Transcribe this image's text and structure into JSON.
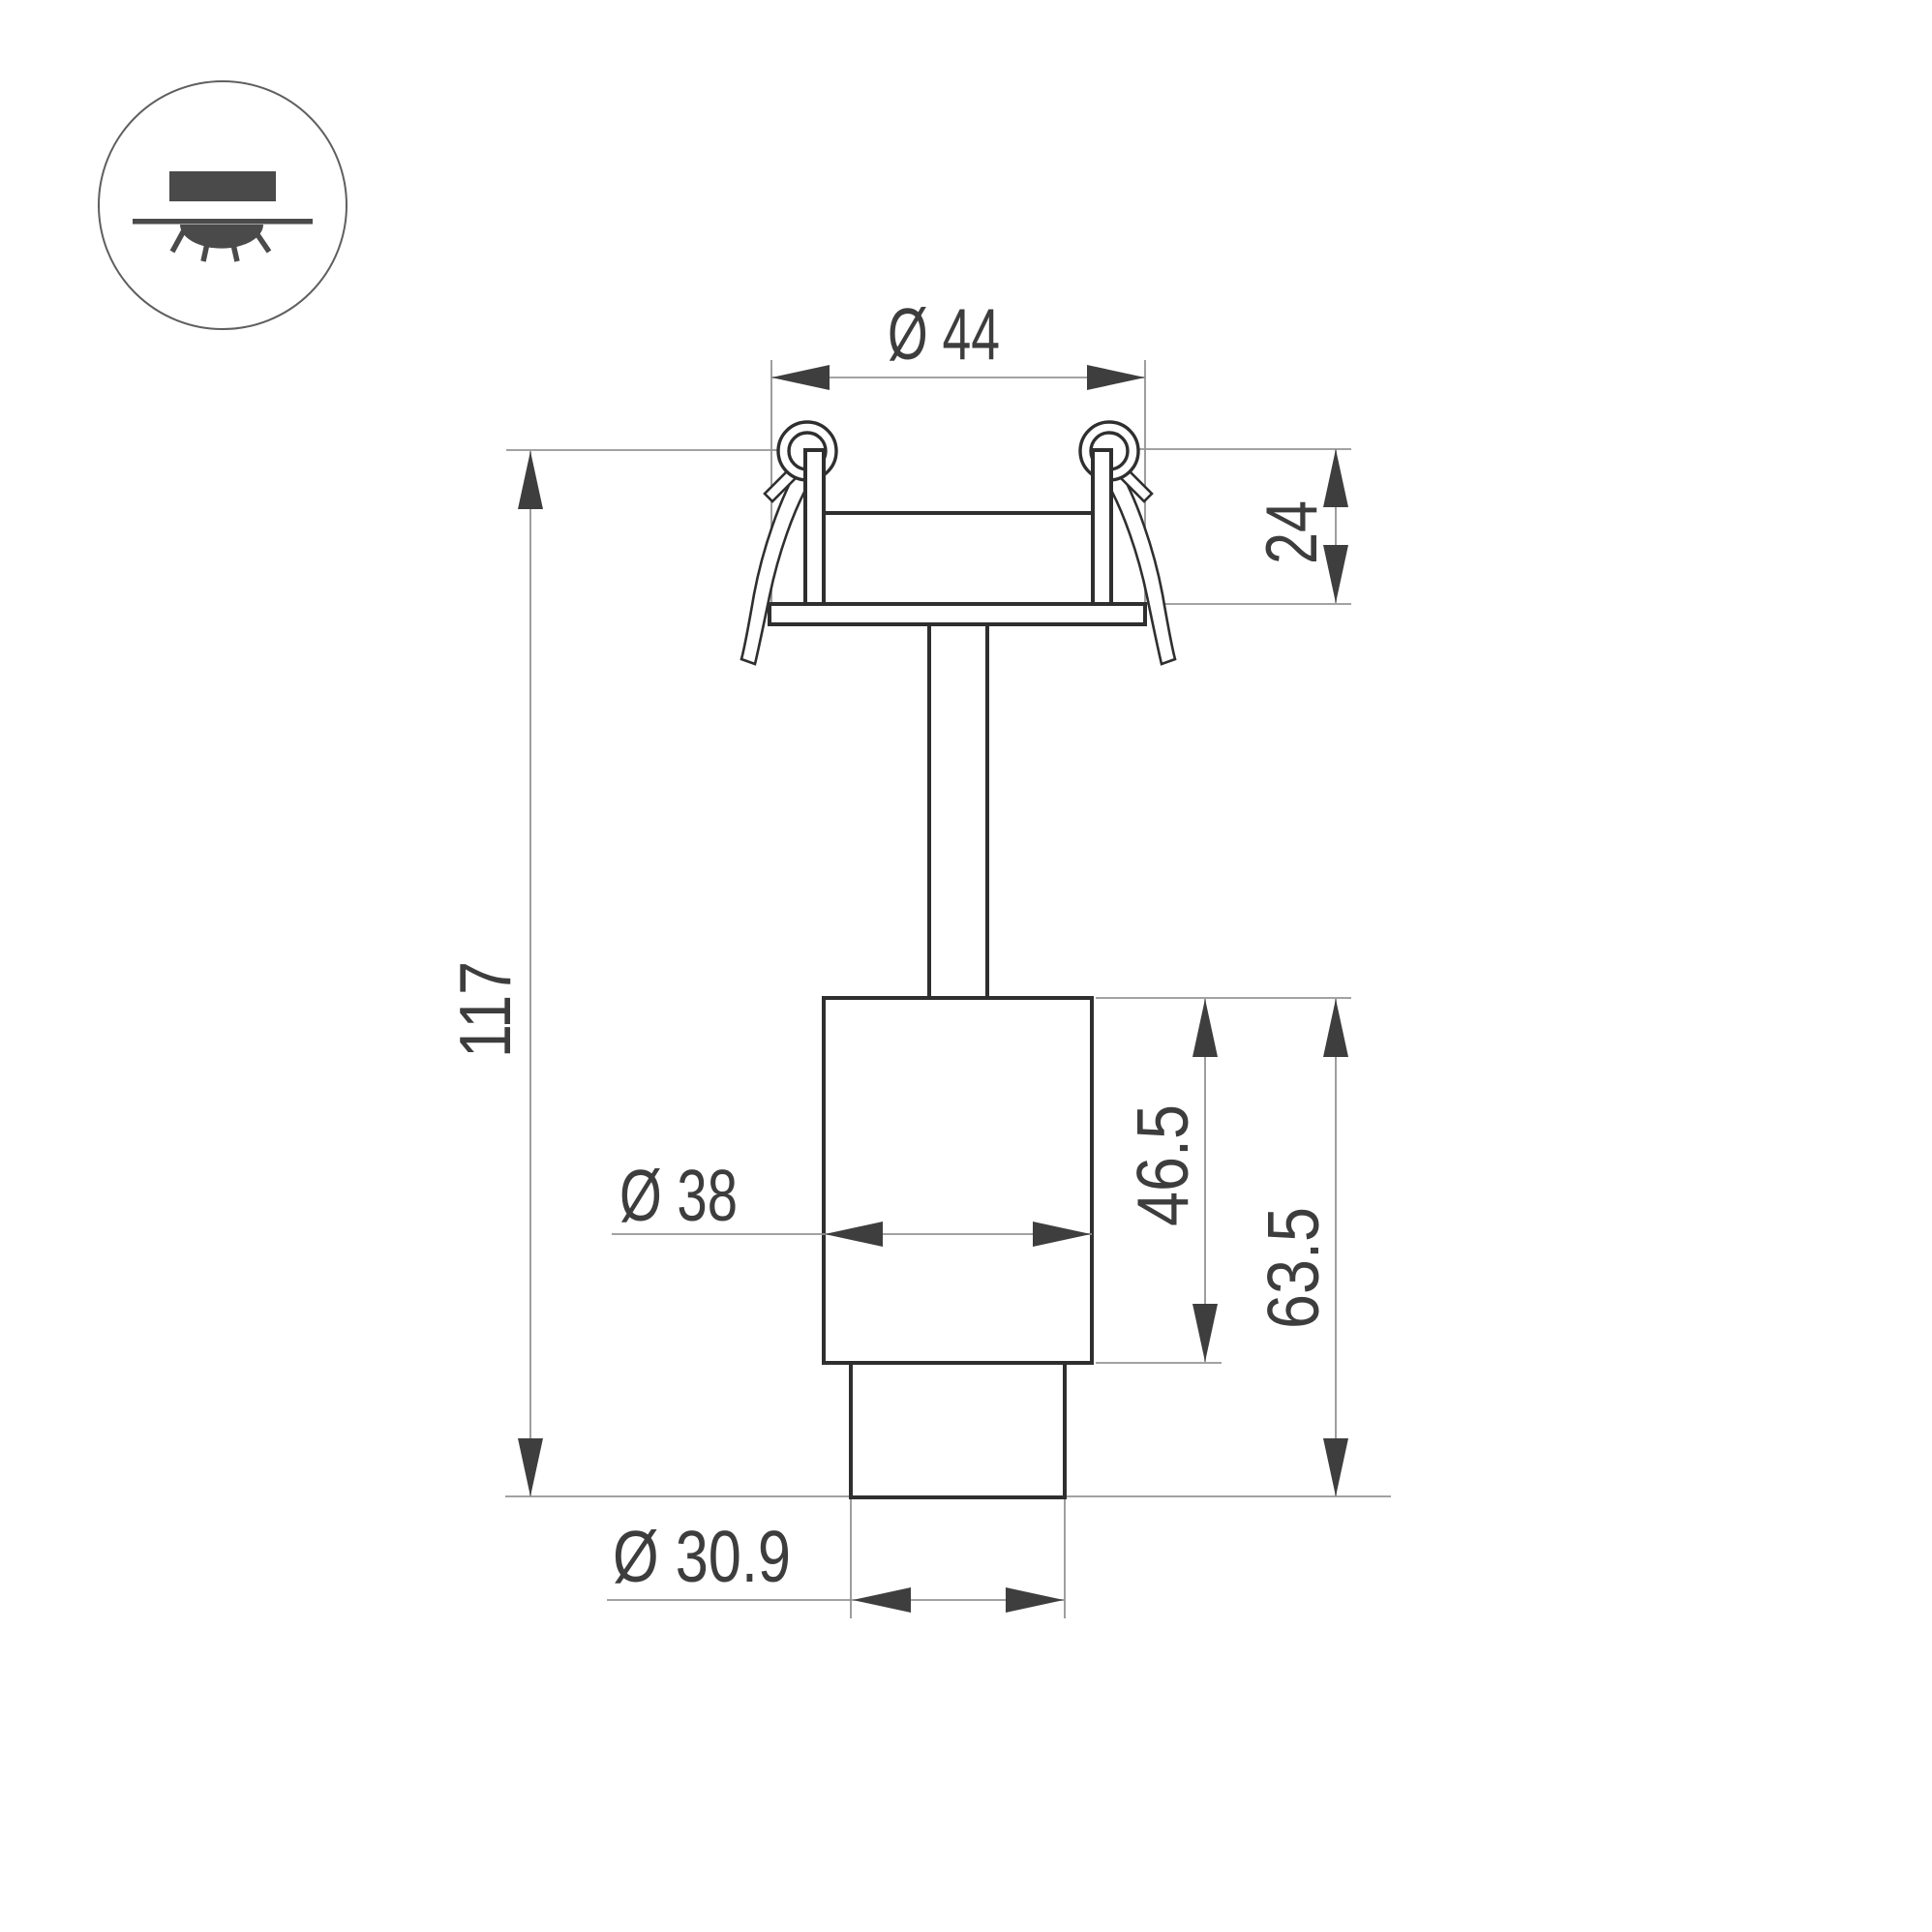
{
  "colors": {
    "paper": "#ffffff",
    "ink": "#2f2f2f",
    "dim_line": "#949494",
    "arrow": "#3e3e3e",
    "text": "#3d3d3d",
    "icon": "#4a4a4a",
    "badge": "#5f5f5f"
  },
  "badge": {
    "icon": "recessed-downlight-icon"
  },
  "dimensions": {
    "top_diameter": "Ø 44",
    "recess_depth": "24",
    "overall_height": "117",
    "body_diameter": "Ø 38",
    "body_height": "46.5",
    "lower_height": "63.5",
    "bottom_diameter": "Ø 30.9"
  }
}
